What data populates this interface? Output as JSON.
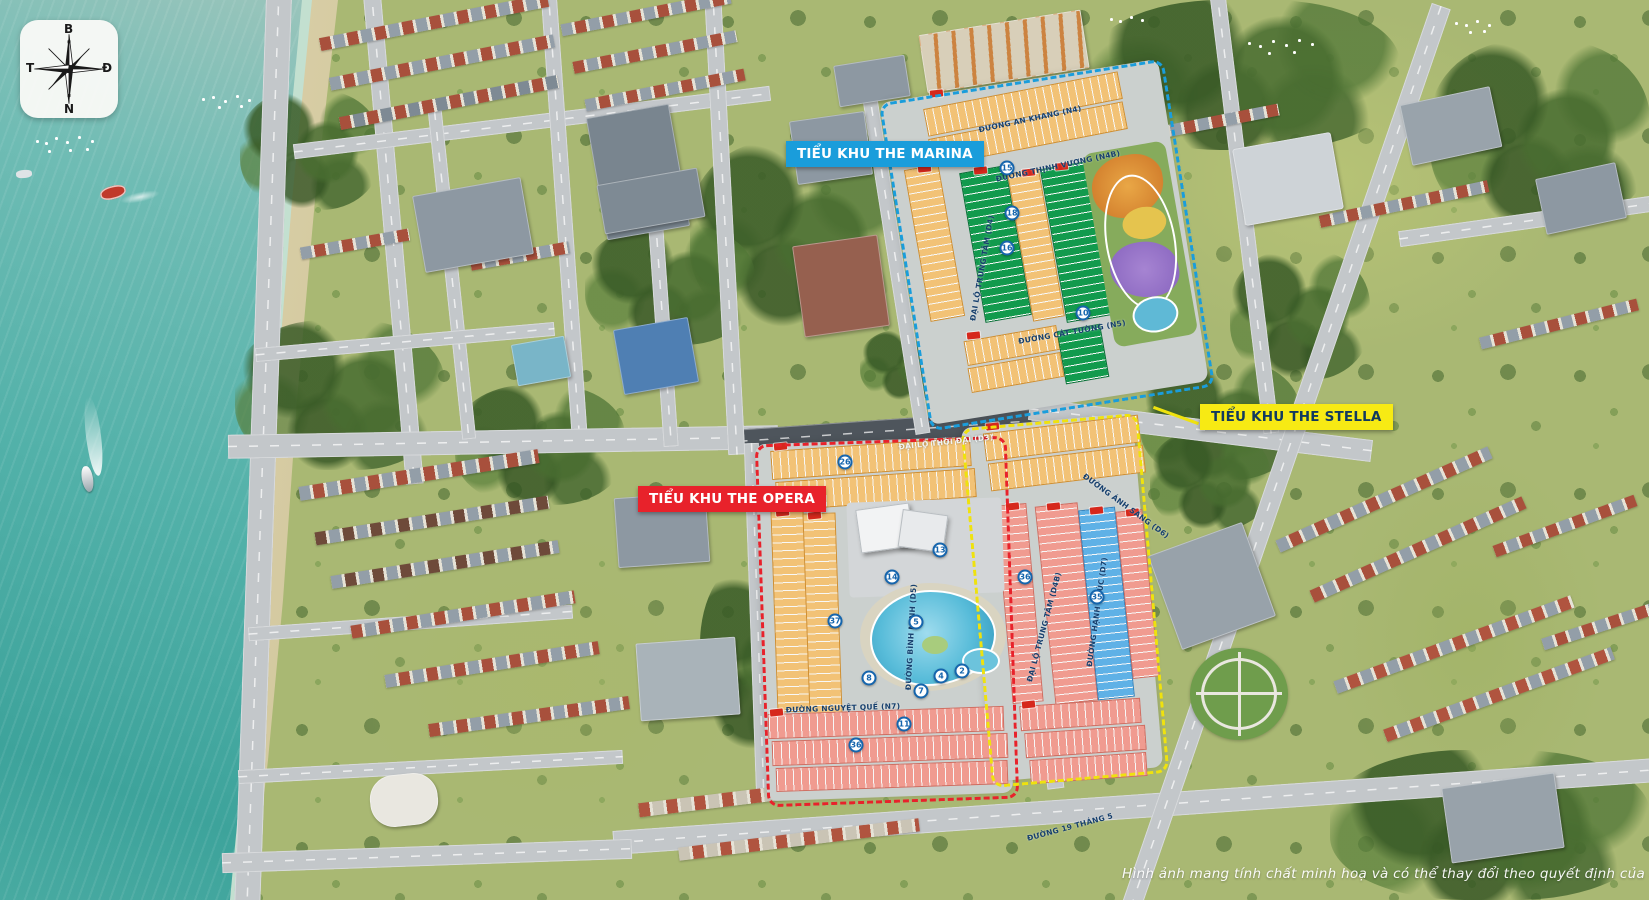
{
  "compass": {
    "north": "B",
    "south": "N",
    "west": "T",
    "east": "Đ"
  },
  "zones": {
    "marina": {
      "label": "TIỂU KHU THE MARINA",
      "bg": "#1a9ddb",
      "text": "#ffffff",
      "border": "#1a9ddb"
    },
    "opera": {
      "label": "TIỂU KHU THE OPERA",
      "bg": "#e8222b",
      "text": "#ffffff",
      "border": "#e8222b"
    },
    "stella": {
      "label": "TIỂU KHU THE STELLA",
      "bg": "#f7ea14",
      "text": "#11395f",
      "border": "#efe20e"
    }
  },
  "streets": [
    {
      "name": "ĐƯỜNG AN KHANG (N4)",
      "x": 1030,
      "y": 119,
      "rot": -12,
      "color": "#17406e"
    },
    {
      "name": "ĐƯỜNG THỊNH VƯỢNG (N4B)",
      "x": 1058,
      "y": 166,
      "rot": -12,
      "color": "#17406e"
    },
    {
      "name": "ĐẠI LỘ TRUNG TÂM (D4)",
      "x": 982,
      "y": 268,
      "rot": -80,
      "color": "#17406e"
    },
    {
      "name": "ĐƯỜNG CÁT TƯỜNG (N5)",
      "x": 1072,
      "y": 332,
      "rot": -10,
      "color": "#17406e"
    },
    {
      "name": "ĐẠI LỘ THỜI ĐẠI (D3)",
      "x": 946,
      "y": 442,
      "rot": -6,
      "color": "#f2f4f5"
    },
    {
      "name": "ĐƯỜNG ÁNH SÁNG (D6)",
      "x": 1126,
      "y": 506,
      "rot": 36,
      "color": "#17406e"
    },
    {
      "name": "ĐƯỜNG BÌNH MINH (D5)",
      "x": 911,
      "y": 637,
      "rot": -87,
      "color": "#17406e"
    },
    {
      "name": "ĐẠI LỘ TRUNG TÂM (D4B)",
      "x": 1044,
      "y": 627,
      "rot": -75,
      "color": "#17406e"
    },
    {
      "name": "ĐƯỜNG HẠNH PHÚC (D7)",
      "x": 1097,
      "y": 612,
      "rot": -82,
      "color": "#17406e"
    },
    {
      "name": "ĐƯỜNG NGUYỆT QUẾ (N7)",
      "x": 843,
      "y": 708,
      "rot": -2,
      "color": "#17406e"
    },
    {
      "name": "ĐƯỜNG 19 THÁNG 5",
      "x": 1070,
      "y": 827,
      "rot": -15,
      "color": "#17406e"
    }
  ],
  "markers": [
    {
      "n": "15",
      "x": 1007,
      "y": 168
    },
    {
      "n": "18",
      "x": 1012,
      "y": 213
    },
    {
      "n": "16",
      "x": 1007,
      "y": 248
    },
    {
      "n": "10",
      "x": 1083,
      "y": 313
    },
    {
      "n": "26",
      "x": 845,
      "y": 462
    },
    {
      "n": "13",
      "x": 940,
      "y": 550
    },
    {
      "n": "14",
      "x": 892,
      "y": 577
    },
    {
      "n": "36",
      "x": 1025,
      "y": 577
    },
    {
      "n": "35",
      "x": 1097,
      "y": 597
    },
    {
      "n": "37",
      "x": 835,
      "y": 621
    },
    {
      "n": "5",
      "x": 916,
      "y": 622
    },
    {
      "n": "2",
      "x": 962,
      "y": 671
    },
    {
      "n": "4",
      "x": 941,
      "y": 676
    },
    {
      "n": "8",
      "x": 869,
      "y": 678
    },
    {
      "n": "7",
      "x": 921,
      "y": 691
    },
    {
      "n": "11",
      "x": 904,
      "y": 724
    },
    {
      "n": "36",
      "x": 856,
      "y": 745
    }
  ],
  "lot_area_samples": [
    "85.0m²",
    "100.0m²",
    "108.8m²",
    "120.0m²",
    "175.8m²",
    "200.0m²"
  ],
  "disclaimer": "Hình ảnh mang tính chất minh hoạ và có thể thay đổi theo quyết định của cơ quan chính quyền"
}
